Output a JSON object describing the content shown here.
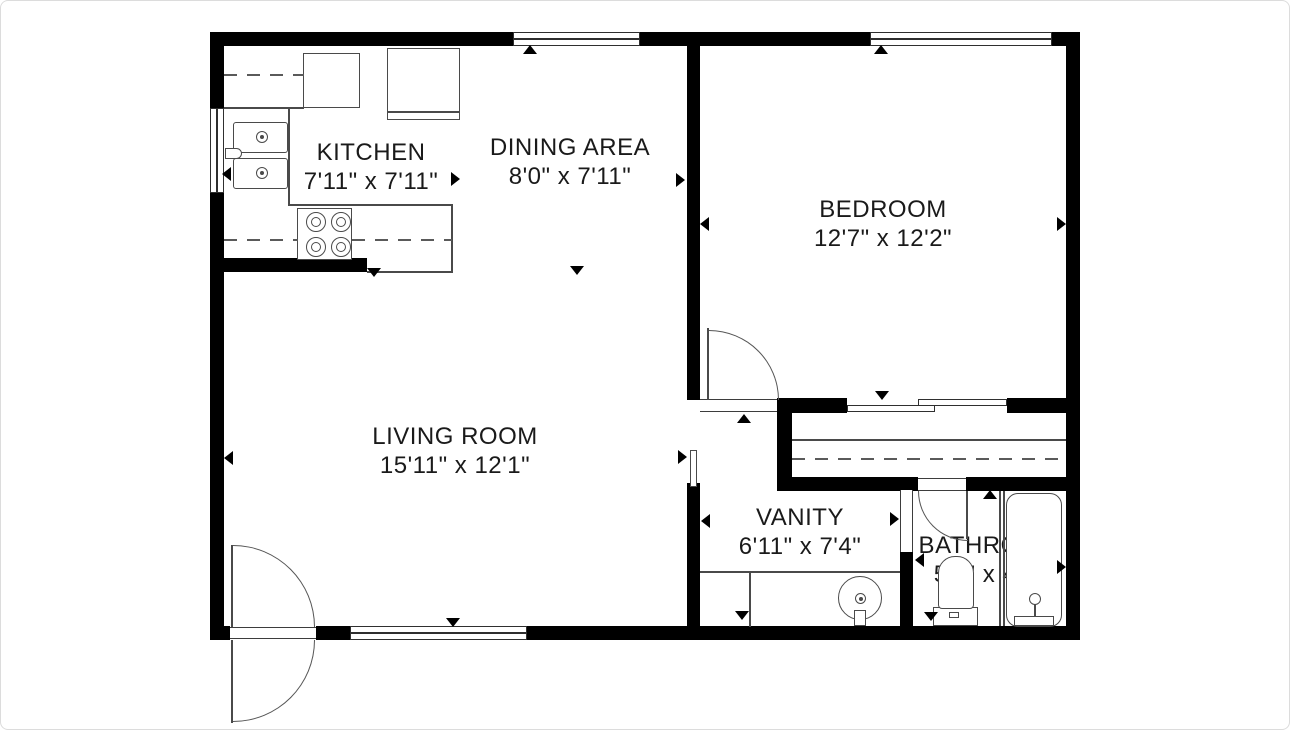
{
  "title": "Apartment floor plan",
  "labels": {
    "dishwasher": "DW"
  },
  "colors": {
    "wall": "#000000",
    "line": "#4a4a4a",
    "text": "#1a1a1a",
    "background": "#ffffff"
  },
  "rooms": [
    {
      "id": "kitchen",
      "name": "KITCHEN",
      "dims": "7'11\" x 7'11\""
    },
    {
      "id": "dining",
      "name": "DINING AREA",
      "dims": "8'0\" x 7'11\""
    },
    {
      "id": "bedroom",
      "name": "BEDROOM",
      "dims": "12'7\" x 12'2\""
    },
    {
      "id": "living",
      "name": "LIVING ROOM",
      "dims": "15'11\" x 12'1\""
    },
    {
      "id": "vanity",
      "name": "VANITY",
      "dims": "6'11\" x 7'4\""
    },
    {
      "id": "bathroom",
      "name": "BATHROOM",
      "dims": "5'2\" x 4'8\""
    }
  ],
  "plan": {
    "elements": [
      {
        "name": "wall-top-left",
        "cls": "wall",
        "x": 210,
        "y": 32,
        "w": 303,
        "h": 14
      },
      {
        "name": "wall-top-middle",
        "cls": "wall",
        "x": 640,
        "y": 32,
        "w": 230,
        "h": 14
      },
      {
        "name": "wall-top-right",
        "cls": "wall",
        "x": 1052,
        "y": 32,
        "w": 28,
        "h": 14
      },
      {
        "name": "wall-left-upper",
        "cls": "wall",
        "x": 210,
        "y": 32,
        "w": 14,
        "h": 76
      },
      {
        "name": "wall-left-lower",
        "cls": "wall",
        "x": 210,
        "y": 193,
        "w": 14,
        "h": 447
      },
      {
        "name": "wall-bottom-left",
        "cls": "wall",
        "x": 210,
        "y": 626,
        "w": 20,
        "h": 14
      },
      {
        "name": "wall-bottom-entry-stub",
        "cls": "wall",
        "x": 316,
        "y": 626,
        "w": 34,
        "h": 14
      },
      {
        "name": "wall-bottom-right",
        "cls": "wall",
        "x": 527,
        "y": 626,
        "w": 553,
        "h": 14
      },
      {
        "name": "wall-right",
        "cls": "wall",
        "x": 1066,
        "y": 32,
        "w": 14,
        "h": 608
      },
      {
        "name": "wall-bedroom-divider",
        "cls": "wall",
        "x": 687,
        "y": 46,
        "w": 13,
        "h": 354
      },
      {
        "name": "wall-kitchen-stub",
        "cls": "wall",
        "x": 210,
        "y": 258,
        "w": 157,
        "h": 14
      },
      {
        "name": "wall-bedroom-door-stub",
        "cls": "wall",
        "x": 777,
        "y": 398,
        "w": 70,
        "h": 15
      },
      {
        "name": "wall-closet-left",
        "cls": "wall",
        "x": 777,
        "y": 398,
        "w": 15,
        "h": 93
      },
      {
        "name": "wall-slider-right-stub",
        "cls": "wall",
        "x": 1007,
        "y": 398,
        "w": 59,
        "h": 15
      },
      {
        "name": "wall-closet-bottom-left",
        "cls": "wall",
        "x": 777,
        "y": 477,
        "w": 141,
        "h": 14
      },
      {
        "name": "wall-closet-bottom-right",
        "cls": "wall",
        "x": 966,
        "y": 477,
        "w": 100,
        "h": 14
      },
      {
        "name": "wall-living-vanity",
        "cls": "wall",
        "x": 687,
        "y": 483,
        "w": 13,
        "h": 143
      },
      {
        "name": "wall-vanity-bathroom",
        "cls": "wall",
        "x": 900,
        "y": 552,
        "w": 13,
        "h": 74
      },
      {
        "name": "window-dining",
        "cls": "win-h",
        "x": 513,
        "y": 32,
        "w": 127,
        "h": 14
      },
      {
        "name": "window-bedroom",
        "cls": "win-h",
        "x": 870,
        "y": 32,
        "w": 182,
        "h": 14
      },
      {
        "name": "window-kitchen",
        "cls": "win-v",
        "x": 210,
        "y": 108,
        "w": 14,
        "h": 85
      },
      {
        "name": "window-living",
        "cls": "win-h",
        "x": 350,
        "y": 626,
        "w": 177,
        "h": 14
      },
      {
        "name": "bedroom-door-threshold",
        "cls": "open-h",
        "x": 700,
        "y": 399,
        "w": 77,
        "h": 13
      },
      {
        "name": "entry-door-threshold",
        "cls": "open-h",
        "x": 230,
        "y": 627,
        "w": 86,
        "h": 12
      },
      {
        "name": "bathroom-door-threshold",
        "cls": "open-h",
        "x": 918,
        "y": 478,
        "w": 48,
        "h": 13
      },
      {
        "name": "vanity-bathroom-opening",
        "cls": "open-v",
        "x": 900,
        "y": 490,
        "w": 13,
        "h": 62
      },
      {
        "name": "living-vanity-opening-frame",
        "cls": "box",
        "x": 690,
        "y": 450,
        "w": 7,
        "h": 37
      },
      {
        "name": "bedroom-door-leaf",
        "cls": "line-v",
        "x": 707,
        "y": 328,
        "w": 2,
        "h": 72
      },
      {
        "name": "bedroom-door-swing-arc",
        "cls": "arc-tr",
        "x": 709,
        "y": 330,
        "w": 70,
        "h": 70
      },
      {
        "name": "entry-door-leaf-inside",
        "cls": "line-v",
        "x": 231,
        "y": 545,
        "w": 2,
        "h": 82
      },
      {
        "name": "entry-door-swing-arc-inside",
        "cls": "arc-tr",
        "x": 233,
        "y": 545,
        "w": 82,
        "h": 82
      },
      {
        "name": "entry-door-leaf-outside",
        "cls": "line-v",
        "x": 231,
        "y": 640,
        "w": 2,
        "h": 83
      },
      {
        "name": "entry-door-swing-arc-outside",
        "cls": "arc-br",
        "x": 233,
        "y": 640,
        "w": 82,
        "h": 82
      },
      {
        "name": "bathroom-door-leaf",
        "cls": "line-v",
        "x": 966,
        "y": 491,
        "w": 2,
        "h": 48
      },
      {
        "name": "bathroom-door-swing-arc",
        "cls": "arc-bl",
        "x": 918,
        "y": 491,
        "w": 50,
        "h": 50
      },
      {
        "name": "closet-sliding-door-rear",
        "cls": "slab",
        "x": 918,
        "y": 399,
        "w": 89,
        "h": 7
      },
      {
        "name": "closet-sliding-door-front",
        "cls": "slab",
        "x": 847,
        "y": 405,
        "w": 88,
        "h": 7
      },
      {
        "name": "closet-rod-line",
        "cls": "line-h",
        "x": 792,
        "y": 439,
        "w": 274,
        "h": 2
      },
      {
        "name": "closet-shelf-dashed-line",
        "cls": "dash-h",
        "x": 792,
        "y": 458,
        "w": 274,
        "h": 2
      },
      {
        "name": "dishwasher-box",
        "cls": "box",
        "x": 303,
        "y": 53,
        "w": 57,
        "h": 55
      },
      {
        "name": "refrigerator-box",
        "cls": "box",
        "x": 387,
        "y": 48,
        "w": 73,
        "h": 72
      },
      {
        "name": "refrigerator-front-line",
        "cls": "line-h",
        "x": 388,
        "y": 111,
        "w": 71,
        "h": 2
      },
      {
        "name": "sink-basin-upper",
        "cls": "box rsink",
        "x": 233,
        "y": 122,
        "w": 55,
        "h": 31
      },
      {
        "name": "sink-basin-lower",
        "cls": "box rsink",
        "x": 233,
        "y": 158,
        "w": 55,
        "h": 31
      },
      {
        "name": "sink-drain-upper",
        "cls": "circle",
        "x": 256,
        "y": 131,
        "w": 12,
        "h": 12
      },
      {
        "name": "sink-drain-upper-dot",
        "cls": "dot",
        "x": 260,
        "y": 135,
        "w": 4,
        "h": 4
      },
      {
        "name": "sink-drain-lower",
        "cls": "circle",
        "x": 256,
        "y": 167,
        "w": 12,
        "h": 12
      },
      {
        "name": "sink-drain-lower-dot",
        "cls": "dot",
        "x": 260,
        "y": 171,
        "w": 4,
        "h": 4
      },
      {
        "name": "kitchen-faucet",
        "cls": "box faucet",
        "x": 225,
        "y": 148,
        "w": 17,
        "h": 11
      },
      {
        "name": "stove-box",
        "cls": "box",
        "x": 297,
        "y": 208,
        "w": 55,
        "h": 52
      },
      {
        "name": "burner-top-left",
        "cls": "circle",
        "x": 306,
        "y": 212,
        "w": 20,
        "h": 20
      },
      {
        "name": "burner-top-right",
        "cls": "circle",
        "x": 331,
        "y": 212,
        "w": 20,
        "h": 20
      },
      {
        "name": "burner-bottom-left",
        "cls": "circle",
        "x": 306,
        "y": 237,
        "w": 20,
        "h": 20
      },
      {
        "name": "burner-bottom-right",
        "cls": "circle",
        "x": 331,
        "y": 237,
        "w": 20,
        "h": 20
      },
      {
        "name": "burner-top-left-inner",
        "cls": "circle",
        "x": 311,
        "y": 217,
        "w": 10,
        "h": 10
      },
      {
        "name": "burner-top-right-inner",
        "cls": "circle",
        "x": 336,
        "y": 217,
        "w": 10,
        "h": 10
      },
      {
        "name": "burner-bottom-left-inner",
        "cls": "circle",
        "x": 311,
        "y": 242,
        "w": 10,
        "h": 10
      },
      {
        "name": "burner-bottom-right-inner",
        "cls": "circle",
        "x": 336,
        "y": 242,
        "w": 10,
        "h": 10
      },
      {
        "name": "counter-edge-vertical",
        "cls": "line-v",
        "x": 288,
        "y": 108,
        "w": 2,
        "h": 97
      },
      {
        "name": "counter-edge-top",
        "cls": "line-h",
        "x": 288,
        "y": 204,
        "w": 165,
        "h": 2
      },
      {
        "name": "counter-edge-right",
        "cls": "line-v",
        "x": 451,
        "y": 205,
        "w": 2,
        "h": 68
      },
      {
        "name": "counter-edge-bottom",
        "cls": "line-h",
        "x": 367,
        "y": 271,
        "w": 86,
        "h": 2
      },
      {
        "name": "counter-edge-upper-left",
        "cls": "line-h",
        "x": 224,
        "y": 107,
        "w": 80,
        "h": 2
      },
      {
        "name": "counter-dashed-top",
        "cls": "dash-h",
        "x": 224,
        "y": 74,
        "w": 80,
        "h": 2
      },
      {
        "name": "counter-dashed-bottom-left",
        "cls": "dash-h",
        "x": 224,
        "y": 239,
        "w": 74,
        "h": 2
      },
      {
        "name": "counter-dashed-bottom-right",
        "cls": "dash-h",
        "x": 352,
        "y": 239,
        "w": 100,
        "h": 2
      },
      {
        "name": "vanity-counter-line",
        "cls": "line-h",
        "x": 700,
        "y": 571,
        "w": 200,
        "h": 2
      },
      {
        "name": "vanity-counter-divider",
        "cls": "line-v",
        "x": 749,
        "y": 572,
        "w": 2,
        "h": 55
      },
      {
        "name": "vanity-sink",
        "cls": "circle",
        "x": 838,
        "y": 576,
        "w": 44,
        "h": 44
      },
      {
        "name": "vanity-sink-drain",
        "cls": "circle",
        "x": 855,
        "y": 593,
        "w": 11,
        "h": 11
      },
      {
        "name": "vanity-sink-drain-dot",
        "cls": "dot",
        "x": 859,
        "y": 597,
        "w": 4,
        "h": 4
      },
      {
        "name": "vanity-faucet",
        "cls": "box",
        "x": 854,
        "y": 610,
        "w": 12,
        "h": 16
      },
      {
        "name": "bathroom-fixture-divider",
        "cls": "line-v",
        "x": 999,
        "y": 491,
        "w": 2,
        "h": 135
      },
      {
        "name": "bathroom-fixture-divider-2",
        "cls": "line-v",
        "x": 1003,
        "y": 491,
        "w": 2,
        "h": 135
      },
      {
        "name": "bathtub",
        "cls": "el tub",
        "x": 1006,
        "y": 493,
        "w": 56,
        "h": 134
      },
      {
        "name": "bathtub-faucet-head",
        "cls": "circle",
        "x": 1029,
        "y": 593,
        "w": 12,
        "h": 12
      },
      {
        "name": "bathtub-faucet-stem",
        "cls": "line-v",
        "x": 1034,
        "y": 604,
        "w": 2,
        "h": 12
      },
      {
        "name": "bathtub-drain-base",
        "cls": "box",
        "x": 1014,
        "y": 616,
        "w": 40,
        "h": 10
      },
      {
        "name": "toilet-tank",
        "cls": "box",
        "x": 933,
        "y": 607,
        "w": 45,
        "h": 19
      },
      {
        "name": "toilet-bowl",
        "cls": "bowl",
        "x": 938,
        "y": 556,
        "w": 36,
        "h": 53
      },
      {
        "name": "toilet-handle",
        "cls": "box",
        "x": 949,
        "y": 612,
        "w": 10,
        "h": 6
      },
      {
        "name": "dimension-arrow-dining-up",
        "cls": "tri-up",
        "x": 523,
        "y": 45
      },
      {
        "name": "dimension-arrow-bedroom-up",
        "cls": "tri-up",
        "x": 874,
        "y": 45
      },
      {
        "name": "dimension-arrow-dining-right",
        "cls": "tri-right",
        "x": 676,
        "y": 173
      },
      {
        "name": "dimension-arrow-bedroom-left",
        "cls": "tri-left",
        "x": 700,
        "y": 217
      },
      {
        "name": "dimension-arrow-bedroom-right",
        "cls": "tri-right",
        "x": 1057,
        "y": 217
      },
      {
        "name": "dimension-arrow-kitchen-right",
        "cls": "tri-right",
        "x": 451,
        "y": 172
      },
      {
        "name": "dimension-arrow-kitchen-left",
        "cls": "tri-left",
        "x": 222,
        "y": 167
      },
      {
        "name": "dimension-arrow-kitchen-down",
        "cls": "tri-down",
        "x": 367,
        "y": 268
      },
      {
        "name": "dimension-arrow-dining-down",
        "cls": "tri-down",
        "x": 570,
        "y": 266
      },
      {
        "name": "dimension-arrow-hall-up",
        "cls": "tri-up",
        "x": 737,
        "y": 414
      },
      {
        "name": "dimension-arrow-closet-down",
        "cls": "tri-down",
        "x": 875,
        "y": 391
      },
      {
        "name": "dimension-arrow-living-left",
        "cls": "tri-left",
        "x": 224,
        "y": 451
      },
      {
        "name": "dimension-arrow-living-down",
        "cls": "tri-down",
        "x": 446,
        "y": 618
      },
      {
        "name": "dimension-arrow-living-right",
        "cls": "tri-right",
        "x": 678,
        "y": 450
      },
      {
        "name": "dimension-arrow-vanity-left",
        "cls": "tri-left",
        "x": 701,
        "y": 514
      },
      {
        "name": "dimension-arrow-vanity-right",
        "cls": "tri-right",
        "x": 890,
        "y": 512
      },
      {
        "name": "dimension-arrow-vanity-down",
        "cls": "tri-down",
        "x": 735,
        "y": 611
      },
      {
        "name": "dimension-arrow-bathroom-left",
        "cls": "tri-left",
        "x": 915,
        "y": 553
      },
      {
        "name": "dimension-arrow-bathroom-up",
        "cls": "tri-up",
        "x": 983,
        "y": 490
      },
      {
        "name": "dimension-arrow-bathroom-down",
        "cls": "tri-down",
        "x": 924,
        "y": 612
      },
      {
        "name": "dimension-arrow-bathroom-right",
        "cls": "tri-right",
        "x": 1057,
        "y": 560
      }
    ]
  }
}
